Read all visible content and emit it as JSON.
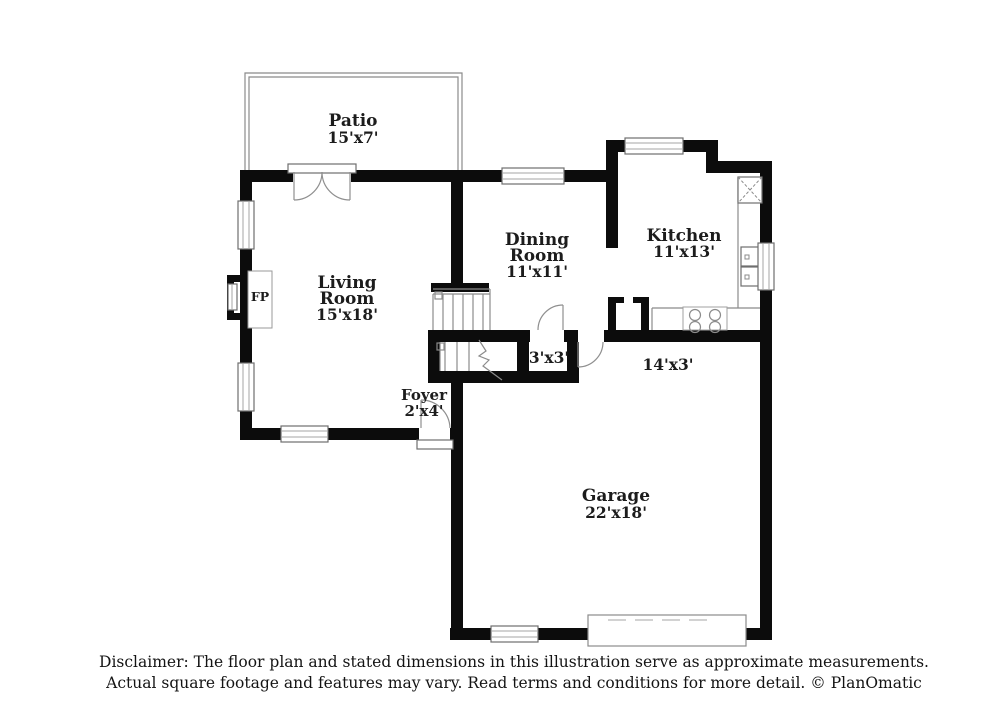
{
  "rooms": {
    "patio": {
      "name": "Patio",
      "dims": "15'x7'"
    },
    "living": {
      "line1": "Living",
      "line2": "Room",
      "dims": "15'x18'"
    },
    "dining": {
      "line1": "Dining",
      "line2": "Room",
      "dims": "11'x11'"
    },
    "kitchen": {
      "name": "Kitchen",
      "dims": "11'x13'"
    },
    "foyer": {
      "name": "Foyer",
      "dims": "2'x4'"
    },
    "garage": {
      "name": "Garage",
      "dims": "22'x18'"
    },
    "closet_dims": "3'x3'",
    "hall_dims": "14'x3'",
    "fireplace_label": "FP"
  },
  "footer": {
    "line1": "Disclaimer: The floor plan and stated dimensions in this illustration serve as approximate measurements.",
    "line2": "Actual square footage and features may vary. Read terms and conditions for more detail. © PlanOmatic"
  },
  "colors": {
    "wall": "#0c0c0c",
    "thin_line": "#8b8b8b",
    "text": "#1c1c1c"
  }
}
